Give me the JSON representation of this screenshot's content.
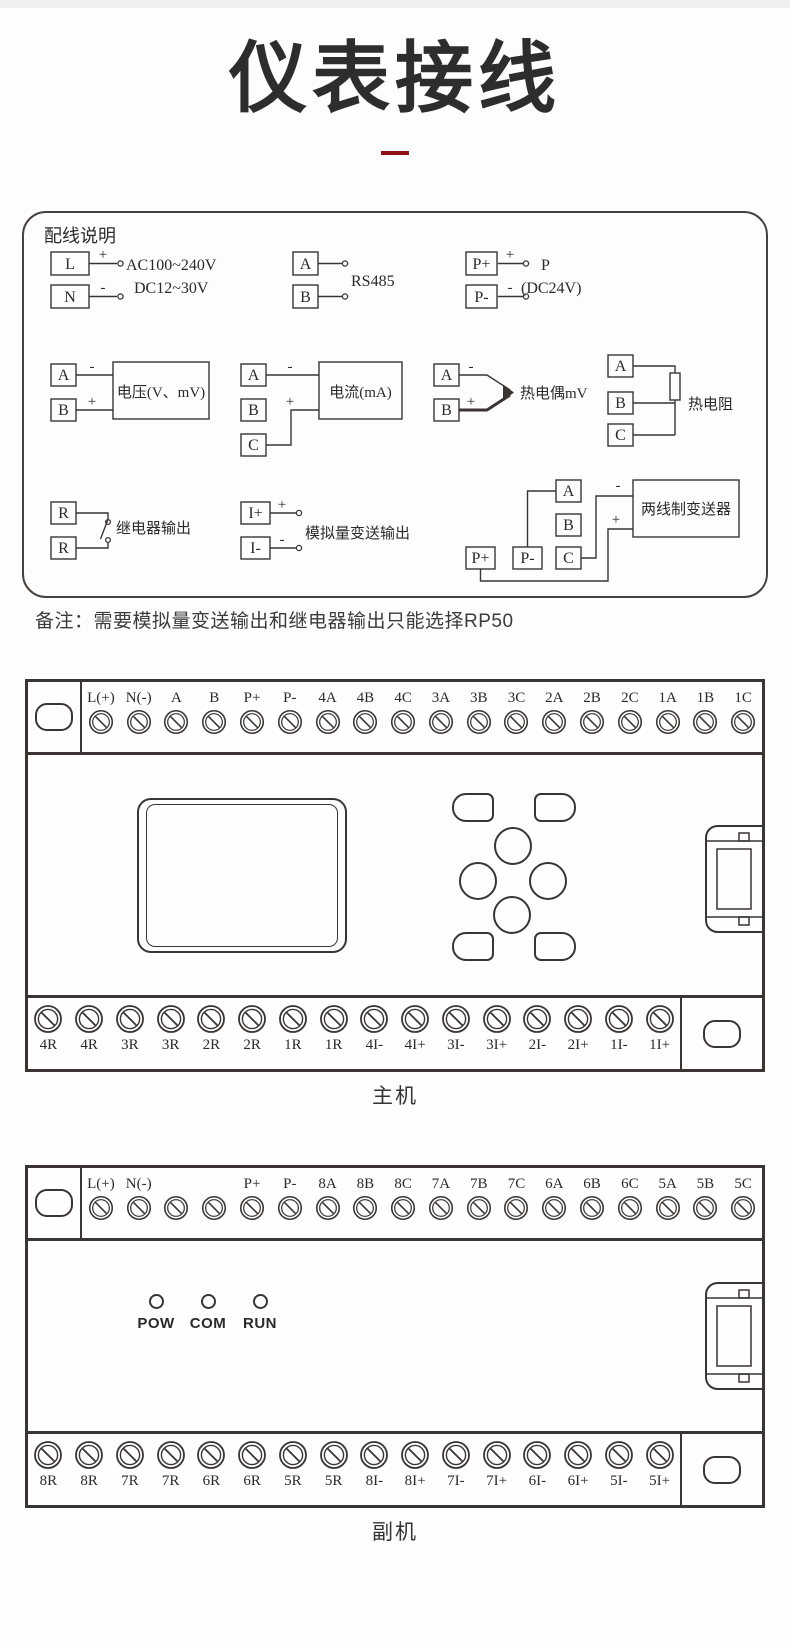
{
  "colors": {
    "line": "#3a3532",
    "text": "#2d2a28",
    "accent_red": "#8e1115",
    "page_background": "#fdfdfd",
    "top_band": "#f1efef"
  },
  "header": {
    "title": "仪表接线"
  },
  "wiring_box": {
    "heading": "配线说明",
    "power": {
      "terminal_top": "L",
      "terminal_bottom": "N",
      "sign_top": "+",
      "sign_bottom": "-",
      "line1": "AC100~240V",
      "line2": "DC12~30V"
    },
    "rs485": {
      "terminal_top": "A",
      "terminal_bottom": "B",
      "label": "RS485"
    },
    "aux_power": {
      "terminal_top": "P+",
      "terminal_bottom": "P-",
      "sign_top": "+",
      "sign_bottom": "-",
      "line1": "P",
      "line2": "(DC24V)"
    },
    "voltage": {
      "terminal_top": "A",
      "terminal_bottom": "B",
      "sign_top": "-",
      "sign_bottom": "+",
      "label": "电压(V、mV)"
    },
    "current": {
      "terminal_top": "A",
      "terminal_mid": "B",
      "terminal_bottom": "C",
      "sign_top": "-",
      "sign_bottom": "+",
      "label": "电流(mA)"
    },
    "thermocouple": {
      "terminal_top": "A",
      "terminal_bottom": "B",
      "sign_top": "-",
      "sign_bottom": "+",
      "label": "热电偶mV"
    },
    "rtd": {
      "terminal_top": "A",
      "terminal_mid": "B",
      "terminal_bottom": "C",
      "label": "热电阻"
    },
    "relay": {
      "terminal_top": "R",
      "terminal_bottom": "R",
      "label": "继电器输出"
    },
    "analog_out": {
      "terminal_top": "I+",
      "terminal_bottom": "I-",
      "sign_top": "+",
      "sign_bottom": "-",
      "label": "模拟量变送输出"
    },
    "transmitter": {
      "tA": "A",
      "tB": "B",
      "tC": "C",
      "tPplus": "P+",
      "tPminus": "P-",
      "sign_minus": "-",
      "sign_plus": "+",
      "label": "两线制变送器"
    }
  },
  "note": "备注：需要模拟量变送输出和继电器输出只能选择RP50",
  "main_unit": {
    "name": "主机",
    "top_terminals": [
      "L(+)",
      "N(-)",
      "A",
      "B",
      "P+",
      "P-",
      "4A",
      "4B",
      "4C",
      "3A",
      "3B",
      "3C",
      "2A",
      "2B",
      "2C",
      "1A",
      "1B",
      "1C"
    ],
    "bottom_terminals": [
      "4R",
      "4R",
      "3R",
      "3R",
      "2R",
      "2R",
      "1R",
      "1R",
      "4I-",
      "4I+",
      "3I-",
      "3I+",
      "2I-",
      "2I+",
      "1I-",
      "1I+"
    ]
  },
  "secondary_unit": {
    "name": "副机",
    "top_terminals": [
      "L(+)",
      "N(-)",
      "",
      "",
      "P+",
      "P-",
      "8A",
      "8B",
      "8C",
      "7A",
      "7B",
      "7C",
      "6A",
      "6B",
      "6C",
      "5A",
      "5B",
      "5C"
    ],
    "bottom_terminals": [
      "8R",
      "8R",
      "7R",
      "7R",
      "6R",
      "6R",
      "5R",
      "5R",
      "8I-",
      "8I+",
      "7I-",
      "7I+",
      "6I-",
      "6I+",
      "5I-",
      "5I+"
    ],
    "led_labels": [
      "POW",
      "COM",
      "RUN"
    ]
  },
  "icons": {
    "screw_terminal": "circle-with-diagonal-slash",
    "mounting_hole": "oval",
    "led": "small-circle",
    "display": "rounded-screen",
    "keypad": "four-direction-keys-with-corner-buttons",
    "side_connector": "expansion-port"
  }
}
